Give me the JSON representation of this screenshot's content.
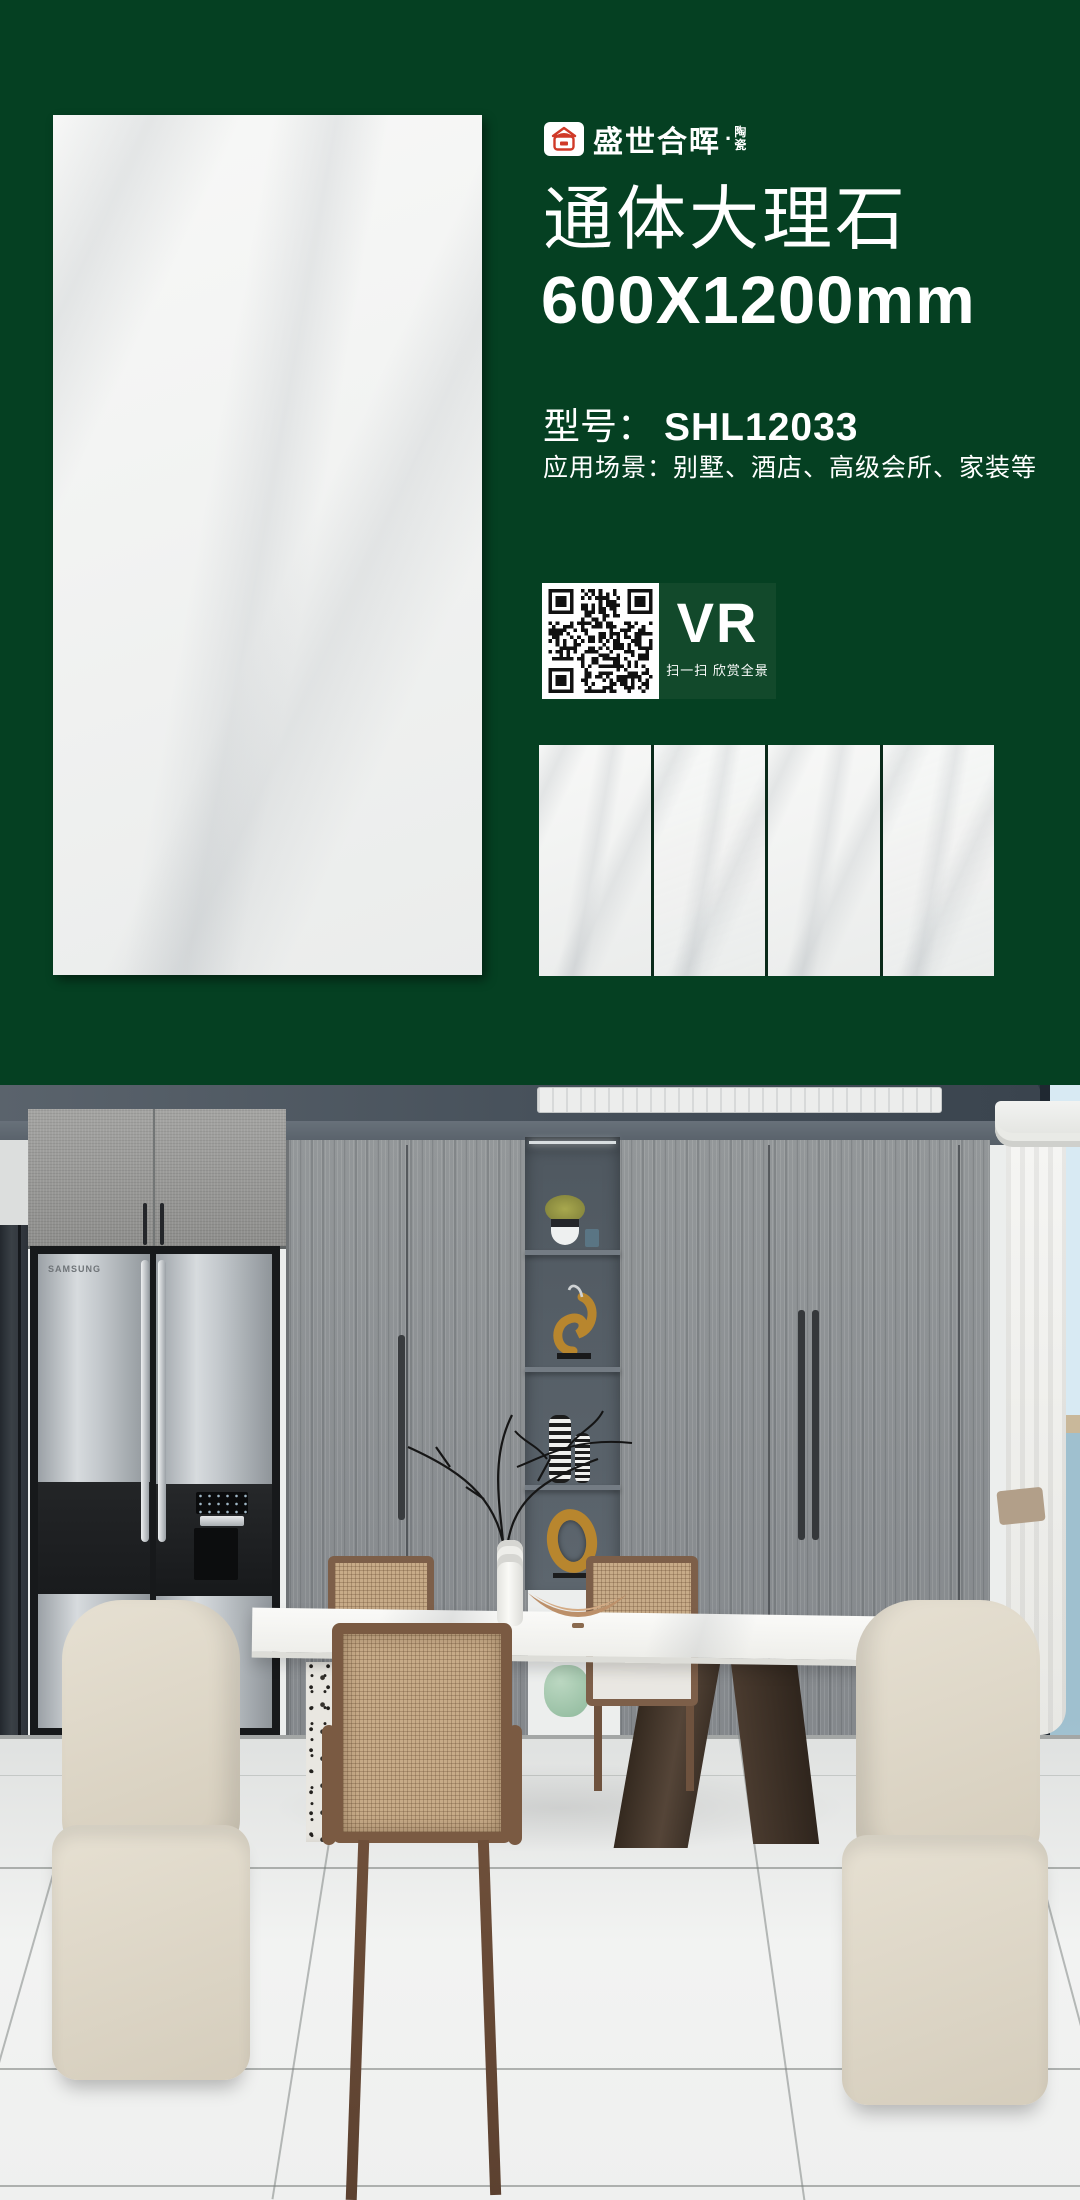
{
  "header": {
    "brand": {
      "name": "盛世合晖",
      "dot": "·",
      "suffix_top": "陶",
      "suffix_bottom": "瓷"
    },
    "title": "通体大理石",
    "size": "600X1200mm",
    "model_label": "型号：",
    "model_value": "SHL12033",
    "application_label": "应用场景：",
    "application_value": "别墅、酒店、高级会所、家装等",
    "vr": {
      "label": "VR",
      "hint": "扫一扫 欣赏全景"
    }
  },
  "scene": {
    "fridge_brand": "SAMSUNG"
  },
  "colors": {
    "background_green": "#054022",
    "vr_panel_green": "#12492b",
    "logo_red": "#d03a28",
    "tile_white": "#f0f1ef",
    "ceiling_gray": "#49525b",
    "sea_blue": "#a3c3d1"
  }
}
